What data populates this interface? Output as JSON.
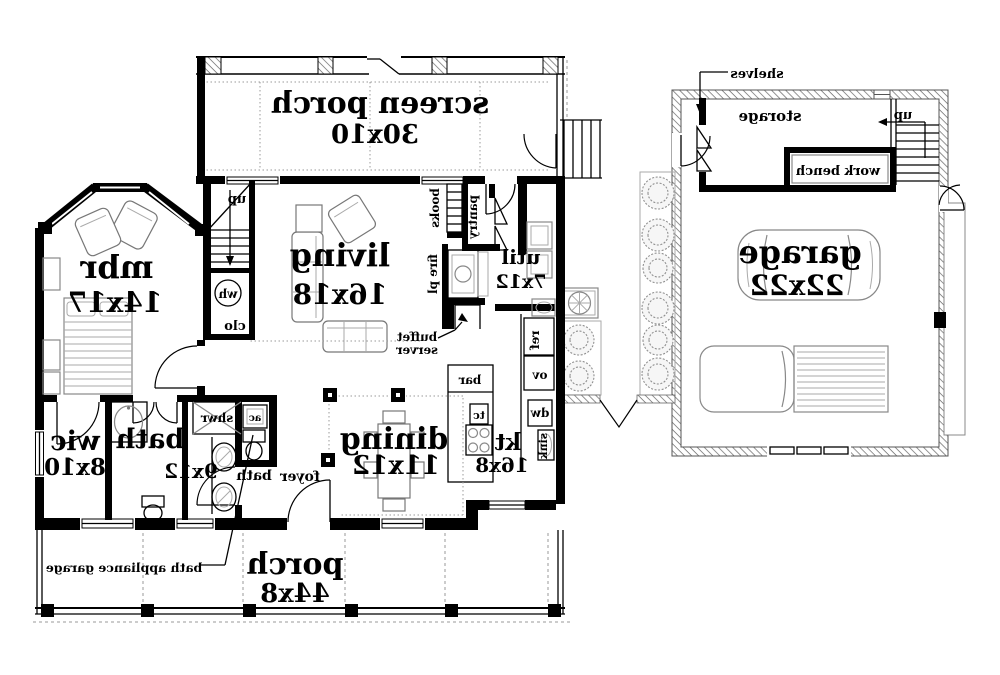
{
  "rooms": {
    "screen_porch": {
      "name": "screen porch",
      "dims": "30x10"
    },
    "living": {
      "name": "living",
      "dims": "16x18"
    },
    "mbr": {
      "name": "mbr",
      "dims": "14x17"
    },
    "util": {
      "name": "util",
      "dims": "7x12"
    },
    "dining": {
      "name": "dining",
      "dims": "11x12"
    },
    "kitchen": {
      "name": "kt",
      "dims": "16x8"
    },
    "bath": {
      "name": "bath",
      "dims": "9x12"
    },
    "bath2": {
      "name": "bath"
    },
    "wic": {
      "name": "wic",
      "dims": "8x10"
    },
    "foyer": {
      "name": "foyer"
    },
    "porch": {
      "name": "porch",
      "dims": "44x8"
    },
    "garage": {
      "name": "garage",
      "dims": "22x22"
    },
    "storage": {
      "name": "storage"
    }
  },
  "fixtures": {
    "up_house": "up",
    "up_garage": "up",
    "wh": "wh",
    "clo": "clo",
    "books": "books",
    "pantry": "pantry",
    "fire_pl": "fire pl",
    "buffet": "buffet",
    "server": "server",
    "ref": "ref",
    "ov": "ov",
    "dw": "dw",
    "sink": "sink",
    "bar": "bar",
    "tc": "tc",
    "shwr": "shwr",
    "ac": "ac",
    "work_bench": "work bench",
    "shelves": "shelves",
    "bath_appliance_garage": "bath appliance garage"
  },
  "colors": {
    "wall": "#000000",
    "background": "#ffffff",
    "furniture": "#888888",
    "foliage": "#999999"
  }
}
